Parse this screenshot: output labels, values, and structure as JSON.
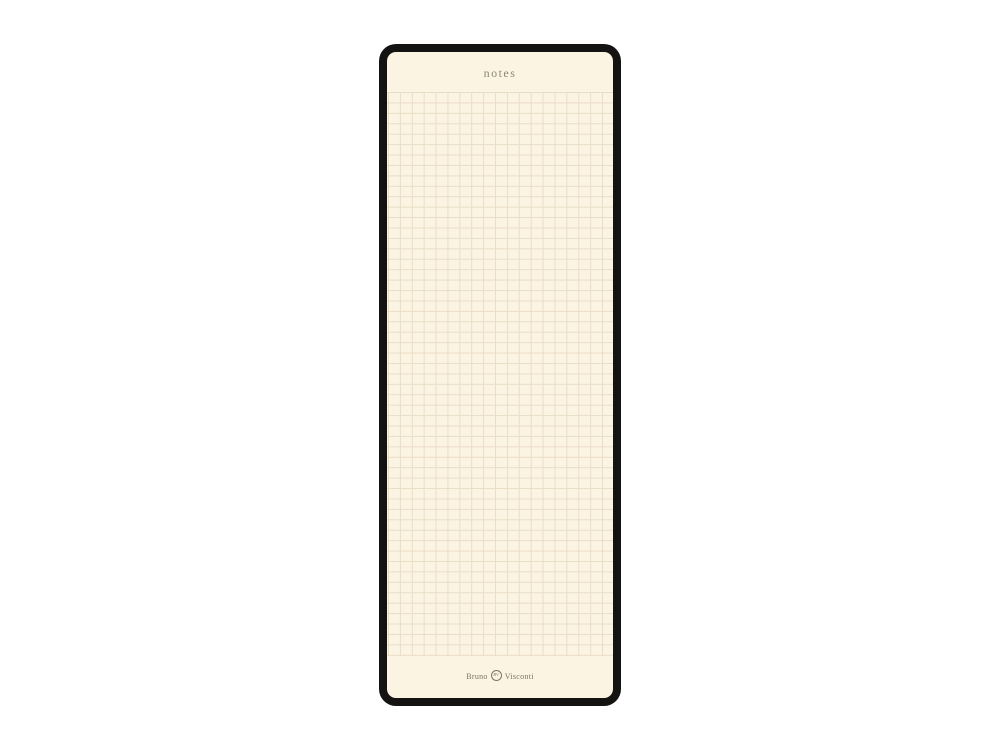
{
  "page": {
    "background": "#ffffff"
  },
  "notepad": {
    "title": "notes",
    "brand": {
      "first": "Bruno",
      "second": "Visconti",
      "monogram": "BV"
    },
    "colors": {
      "page_background": "#ffffff",
      "frame": "#141311",
      "paper": "#fcf4e3",
      "grid_line": "#e9ddc6",
      "title_text": "#8b8677",
      "brand_text": "#7a7565"
    },
    "grid": {
      "cell_width_px": 11.9,
      "cell_height_px": 10.43,
      "columns": 19,
      "rows": 54
    }
  }
}
